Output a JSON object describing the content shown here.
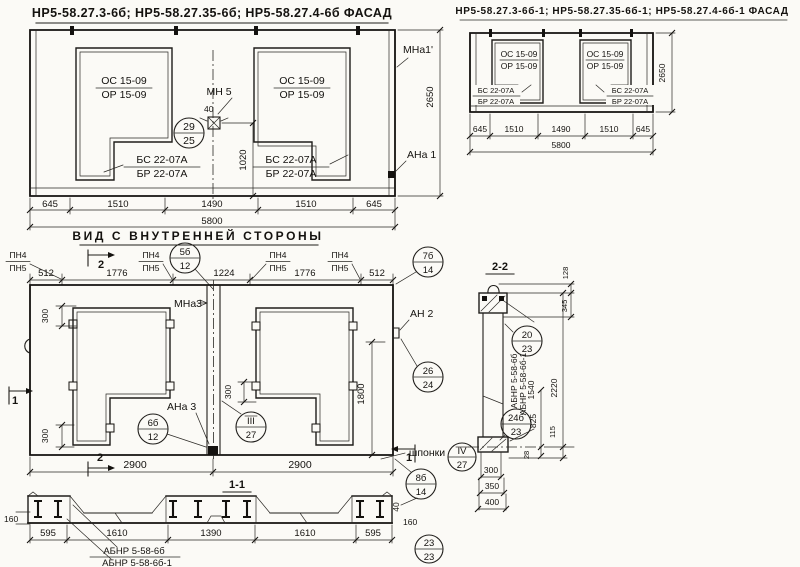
{
  "facade_left": {
    "title": "НР5-58.27.3-6б; НР5-58.27.35-6б; НР5-58.27.4-6б  ФАСАД",
    "win_top": "ОС 15-09",
    "win_bot": "ОР 15-09",
    "bal_top": "БС 22-07А",
    "bal_bot": "БР 22-07А",
    "anchor": "МН 5",
    "anchor_dim": "40",
    "callout": {
      "top": "29",
      "bot": "25"
    },
    "dim_v": "1020",
    "height": "2650",
    "mna": "МНа1'",
    "ana": "АНа 1",
    "dims": [
      "645",
      "1510",
      "1490",
      "1510",
      "645"
    ],
    "total": "5800"
  },
  "facade_right": {
    "title": "НР5-58.27.3-6б-1; НР5-58.27.35-6б-1; НР5-58.27.4-6б-1  ФАСАД",
    "win_top": "ОС 15-09",
    "win_bot": "ОР 15-09",
    "bal_top": "БС 22-07А",
    "bal_bot": "БР 22-07А",
    "height": "2650",
    "dims": [
      "645",
      "1510",
      "1490",
      "1510",
      "645"
    ],
    "total": "5800"
  },
  "inner": {
    "caption": "ВИД С ВНУТРЕННЕЙ СТОРОНЫ",
    "pn_top": "ПН4",
    "pn_bot": "ПН5",
    "dims_top": [
      "512",
      "1776",
      "1224",
      "1776",
      "512"
    ],
    "c5b": [
      "5б",
      "12"
    ],
    "c7b": [
      "7б",
      "14"
    ],
    "c26": [
      "26",
      "24"
    ],
    "c6b": [
      "6б",
      "12"
    ],
    "c3": [
      "III",
      "27"
    ],
    "c4": [
      "IV",
      "27"
    ],
    "c8b": [
      "8б",
      "14"
    ],
    "mna3": "МНа3",
    "an2": "АН 2",
    "ana3": "АНа 3",
    "shponki": "шпонки",
    "d300": "300",
    "d1800": "1800",
    "dims_bottom": [
      "2900",
      "2900"
    ],
    "sec1": "1",
    "sec2": "2"
  },
  "section11": {
    "title": "1-1",
    "dims": [
      "595",
      "1610",
      "1390",
      "1610",
      "595"
    ],
    "d160": "160",
    "d40": "40",
    "label1": "АБНР 5-58-6б",
    "label2": "АБНР 5-58-6б-1",
    "c23": [
      "23",
      "23"
    ]
  },
  "section22": {
    "title": "2-2",
    "label1": "АБНР 5-58-6б",
    "label2": "АБНР 5-58-6б-1",
    "d1540": "1540",
    "d825": "825",
    "d28": "28",
    "d2220": "2220",
    "d115": "115",
    "d345": "345",
    "d128": "128",
    "dims_bottom": [
      "300",
      "350",
      "400"
    ],
    "c20": [
      "20",
      "23"
    ],
    "c24": [
      "24б",
      "23"
    ]
  }
}
